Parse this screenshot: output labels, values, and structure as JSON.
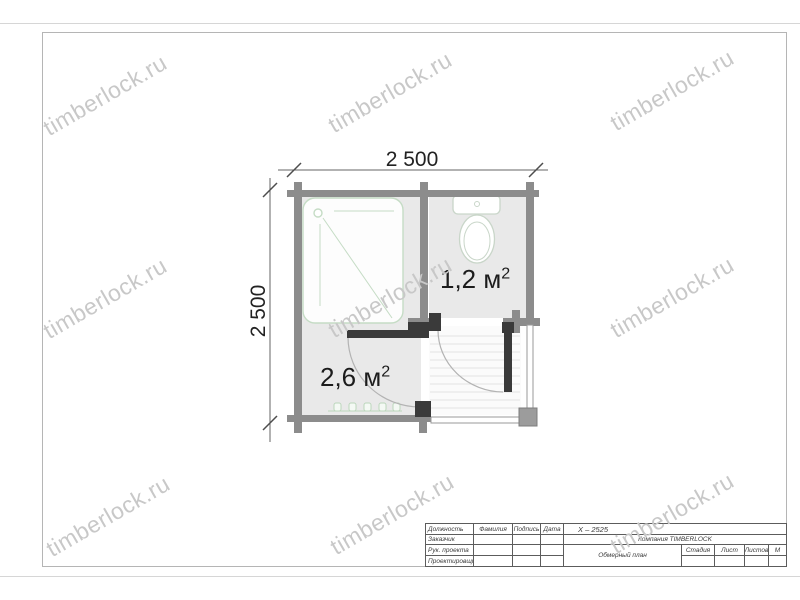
{
  "watermark": {
    "text": "timberlock.ru"
  },
  "drawing": {
    "dim_top": "2 500",
    "dim_left": "2 500",
    "room_wc": {
      "area": "1,2 м",
      "sup": "2"
    },
    "room_shower": {
      "area": "2,6 м",
      "sup": "2"
    },
    "fixtures": {
      "shower": "shower-tray",
      "toilet": "toilet",
      "heater": "heater"
    },
    "colors": {
      "wall": "#8c8c8c",
      "partition": "#3a3a3a",
      "fixture_outline": "#c5dcc5",
      "room_fill": "#e9e9e9"
    }
  },
  "title_block": {
    "position_label": "Должность",
    "name_label": "Фамилия",
    "signature_label": "Подпись",
    "date_label": "Дата",
    "project_code": "X – 2525",
    "customer_label": "Заказчик",
    "company": "Компания  TIMBERLOCK",
    "project_lead_label": "Рук. проекта",
    "designer_label": "Проектировщик",
    "drawing_title": "Обмерный план",
    "stage_label": "Стадия",
    "sheet_label": "Лист",
    "sheets_label": "Листов",
    "scale_label": "М"
  }
}
